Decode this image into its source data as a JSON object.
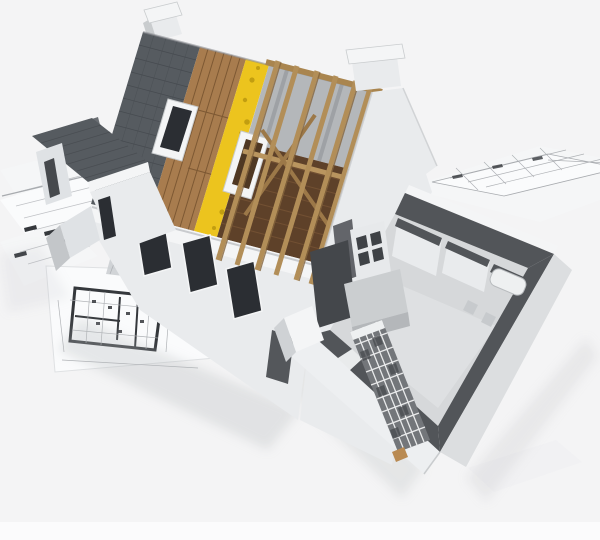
{
  "meta": {
    "title": "3D rendering of a house under construction with cutaway roof layers and ground floor, standing on architectural blueprint sheets",
    "media_type": "3d-architecture-render",
    "visible_text": []
  },
  "scene": {
    "background": "plain light studio backdrop with lighter strip at bottom edge",
    "house": {
      "chimney": "white chimney at top of shingled roof ridge",
      "roof_layers": [
        "dark asphalt shingles",
        "wooden plank sheathing",
        "yellow mineral insulation strip",
        "open timber rafters over attic floor"
      ],
      "roof_windows": [
        "skylight in shingle section",
        "open skylight frame at insulation edge"
      ],
      "gable_wall": "white dutch gable wall with chimney-shaped stepped cap",
      "left_wing": "small gabled wing with gray roof and dark window slots",
      "front_facade": "white rendered wall with dark window and door openings",
      "ground_floor_cutaway": {
        "cut_wall_tops": "dark gray horizontal cut surfaces",
        "rooms": [
          "bathroom with tub and fixtures",
          "large living room",
          "kitchen with counter and shelving"
        ],
        "unfinished_wall": "gray brick lattice wall with white mortar joints"
      }
    },
    "blueprints": {
      "sheets": [
        "left stack of small sheets",
        "large bottom-left sheet with detailed floor plan and hatched walls",
        "right sheet with small plan grid",
        "faint sheet at lower right"
      ],
      "plan_features": [
        "thick dark wall outlines",
        "thin partition lines",
        "dimension ticks",
        "hatch band"
      ]
    }
  },
  "colors": {
    "bg": "#f4f4f5",
    "bgStrip": "#fbfbfc",
    "paper": "#f5f6f7",
    "paperBright": "#fafbfc",
    "paperShade": "#eff0f2",
    "paperEdge": "#dfe1e3",
    "planLine": "#a8abaf",
    "planWall": "#35383c",
    "planHatch": "#c9ccd0",
    "shingle": "#565b60",
    "shingleLine": "#3a3e43",
    "wood": "#a87c4e",
    "woodLine": "#6b4a28",
    "insulation": "#ecc41e",
    "insulationDot": "#b8950d",
    "rafter": "#b28e58",
    "rafterEdge": "#84643c",
    "ridgeBeam": "#a9854f",
    "purlin": "#b9955f",
    "brace": "#9c7848",
    "atticFloor": "#5e4129",
    "atticLine": "#7b5737",
    "frameInner": "#4f3823",
    "farSlope": "#b4b7ba",
    "farSlopeDark": "#8d9094",
    "wallWhite": "#e9ebed",
    "wallBright": "#f4f5f6",
    "wallShade": "#c9ccce",
    "wallShadow": "#9da1a5",
    "wallMid": "#dfe2e5",
    "wallSide": "#c3c6c9",
    "blockSide": "#cfd2d5",
    "grayBlock": "#6a6e73",
    "windowDark": "#2b2e33",
    "doorDark": "#54575b",
    "cutTop": "#525559",
    "floorLight": "#d6d8da",
    "floorBig": "#dfe1e2",
    "faceSE": "#dcdee0",
    "faceSW": "#edeff1",
    "brick": "#73767a",
    "brickDark": "#4b4e52",
    "mortar": "#e8e9ea",
    "counter": "#cbced0",
    "counterFront": "#b4b7ba",
    "shelf": "#e7e9eb",
    "cubby": "#3f4246",
    "interiorDark": "#44474b",
    "bath": "#eef0f1",
    "bathEdge": "#b8bbbe",
    "fixture": "#c7cacd",
    "woodScrap": "#b98a52",
    "shadow": "#b7babd",
    "sill": "#e9ebec"
  }
}
